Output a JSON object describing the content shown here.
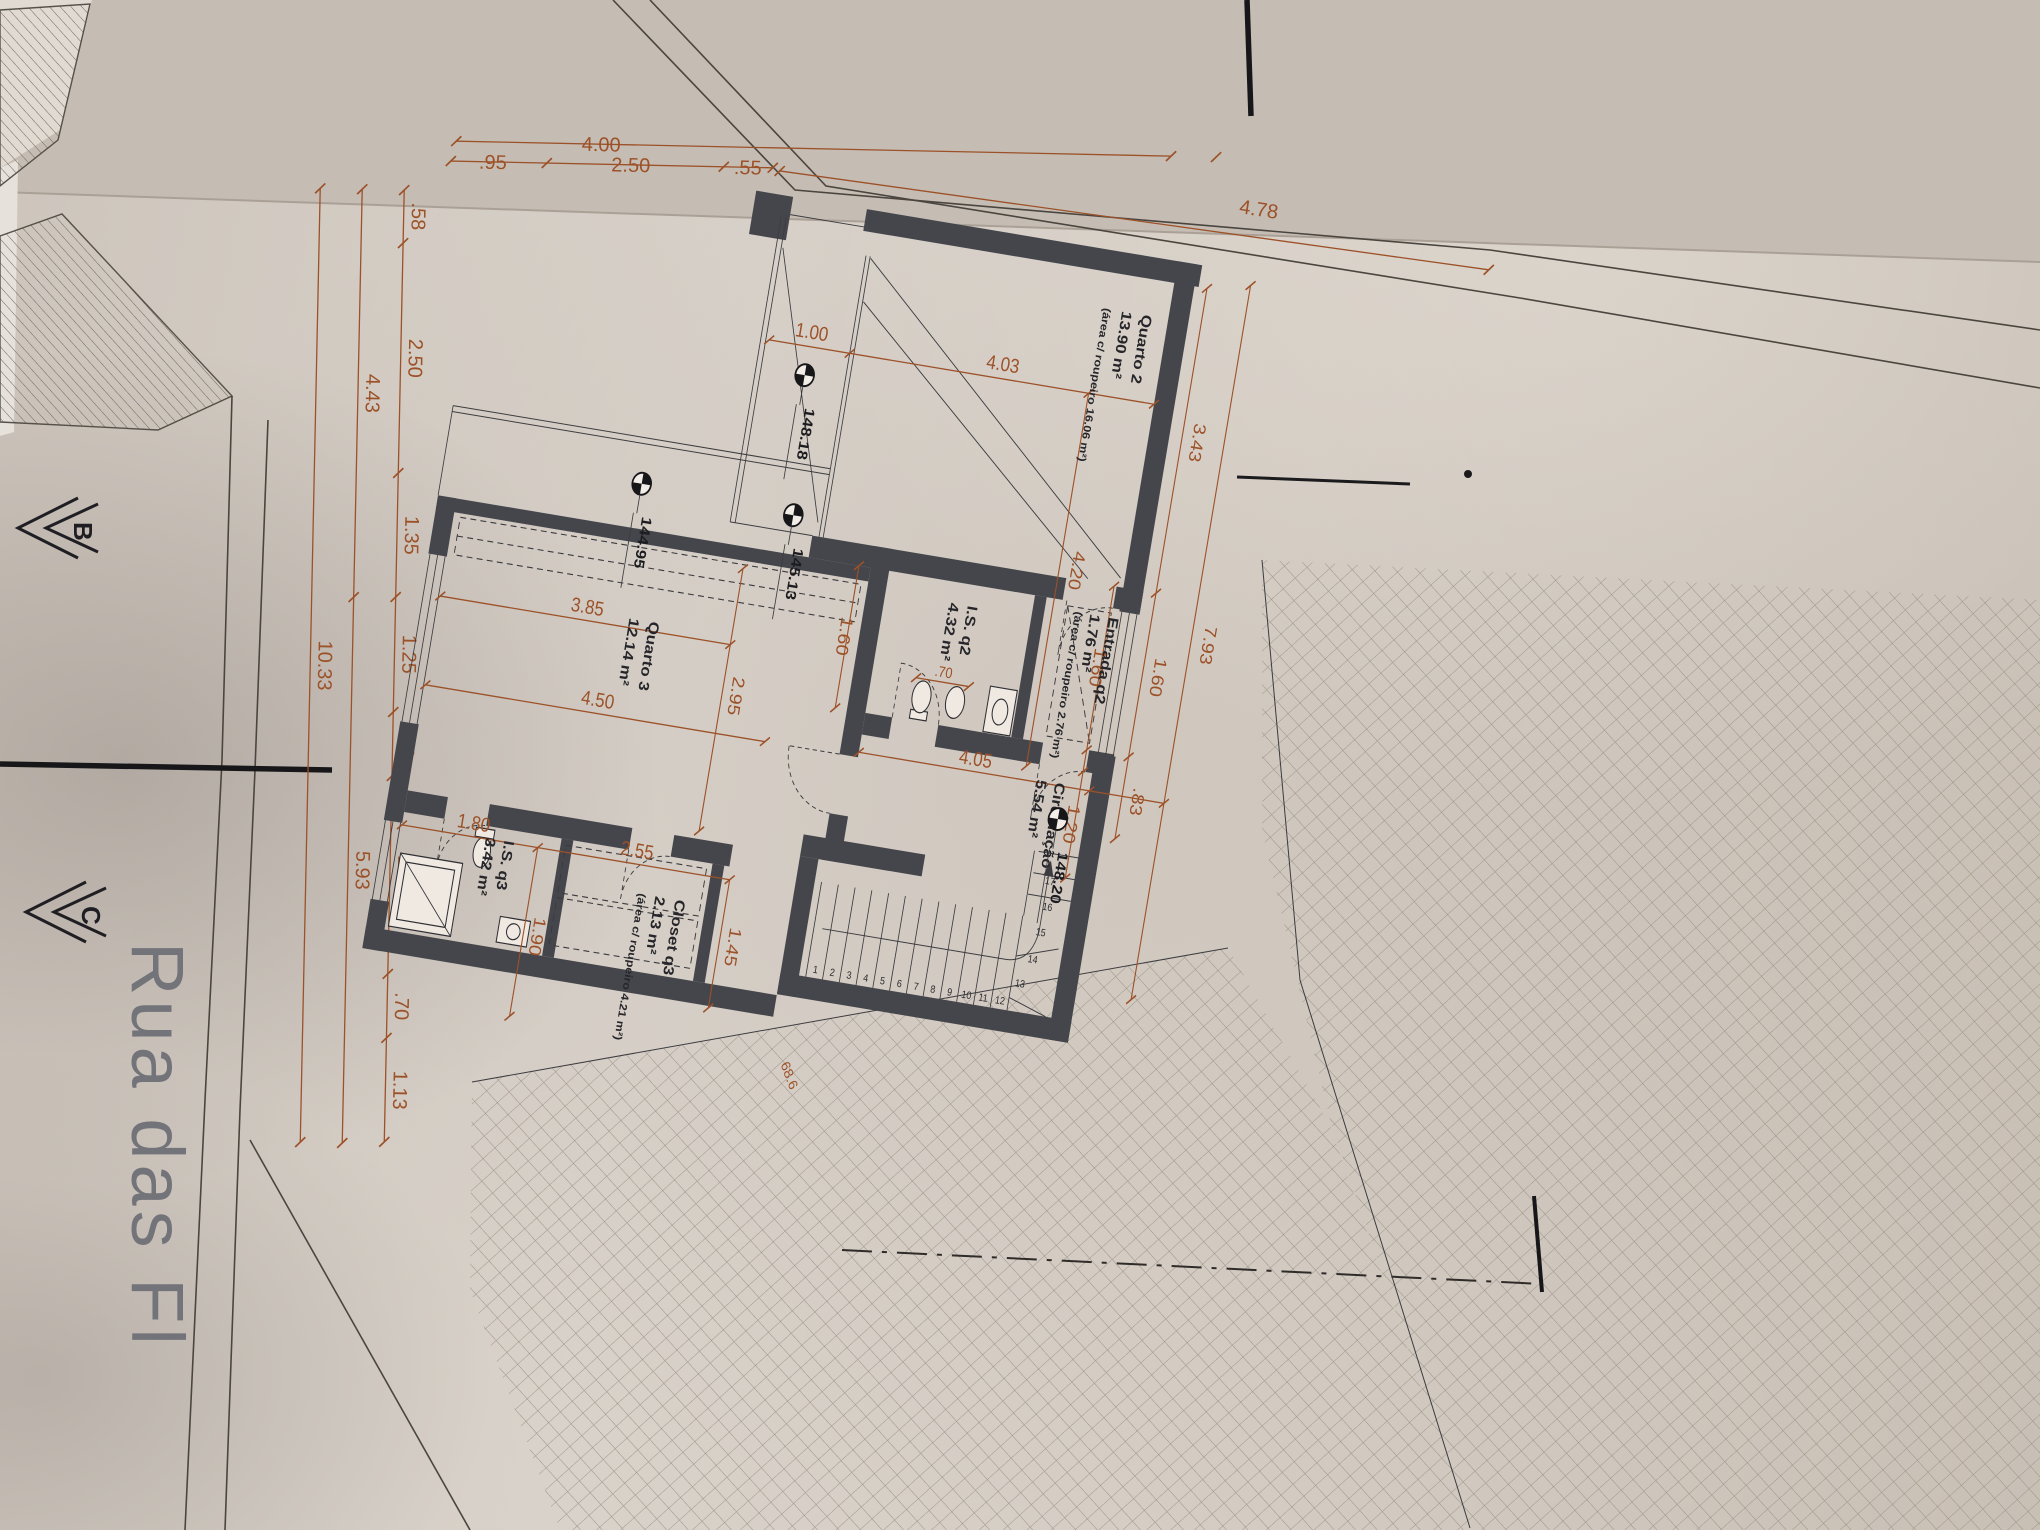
{
  "street": {
    "name": "Rua das Fl"
  },
  "sections": {
    "b": "B",
    "c": "C"
  },
  "site_dims": {
    "d400": "4.00",
    "d95": ".95",
    "d250": "2.50",
    "d55": ".55",
    "d478": "4.78",
    "chain_inner": [
      ".58",
      "2.50",
      "1.35",
      "1.25",
      ".70",
      "2.15",
      ".70",
      "1.13"
    ],
    "chain_mid": [
      "4.43",
      "5.93"
    ],
    "chain_outer": "10.33"
  },
  "plan_dims": {
    "p100": "1.00",
    "p403": "4.03",
    "p420": "4.20",
    "p343": "3.43",
    "p160_win": "1.60",
    "p83": ".83",
    "p793": "7.93",
    "p160_mid": "1.60",
    "p120": "1.20",
    "p160_west": "1.60",
    "p70_wc": ".70",
    "p385": "3.85",
    "p295": "2.95",
    "p450": "4.50",
    "p405": "4.05",
    "p180": "1.80",
    "p190": "1.90",
    "p255": "2.55",
    "p145": "1.45",
    "p686": "68.6"
  },
  "levels": {
    "terrace_q2": "148.18",
    "upper_terrace": "144.95",
    "mid_terrace": "145.13",
    "stairwell": "148.20"
  },
  "rooms": {
    "quarto2": {
      "name": "Quarto 2",
      "area": "13.90 m²",
      "note": "(área c/ roupeiro 16.06 m²)"
    },
    "entrada_q2": {
      "name": "Entrada q2",
      "area": "1.76 m²",
      "note": "(área c/ roupeiro 2.76 m²)"
    },
    "is_q2": {
      "name": "I.S. q2",
      "area": "4.32 m²"
    },
    "circulacao": {
      "name": "Circulação",
      "area": "5.54 m²"
    },
    "quarto3": {
      "name": "Quarto 3",
      "area": "12.14 m²"
    },
    "closet_q3": {
      "name": "Closet q3",
      "area": "2.13 m²",
      "note": "(área c/ roupeiro 4.21 m²)"
    },
    "is_q3": {
      "name": "I.S. q3",
      "area": "3.42 m²"
    }
  },
  "stairs": {
    "steps": [
      "1",
      "2",
      "3",
      "4",
      "5",
      "6",
      "7",
      "8",
      "9",
      "10",
      "11",
      "12",
      "13",
      "14",
      "15",
      "16",
      "17"
    ]
  },
  "colors": {
    "dimension": "#9c5128",
    "wall": "#45464c",
    "paper": "#d6cec5"
  }
}
